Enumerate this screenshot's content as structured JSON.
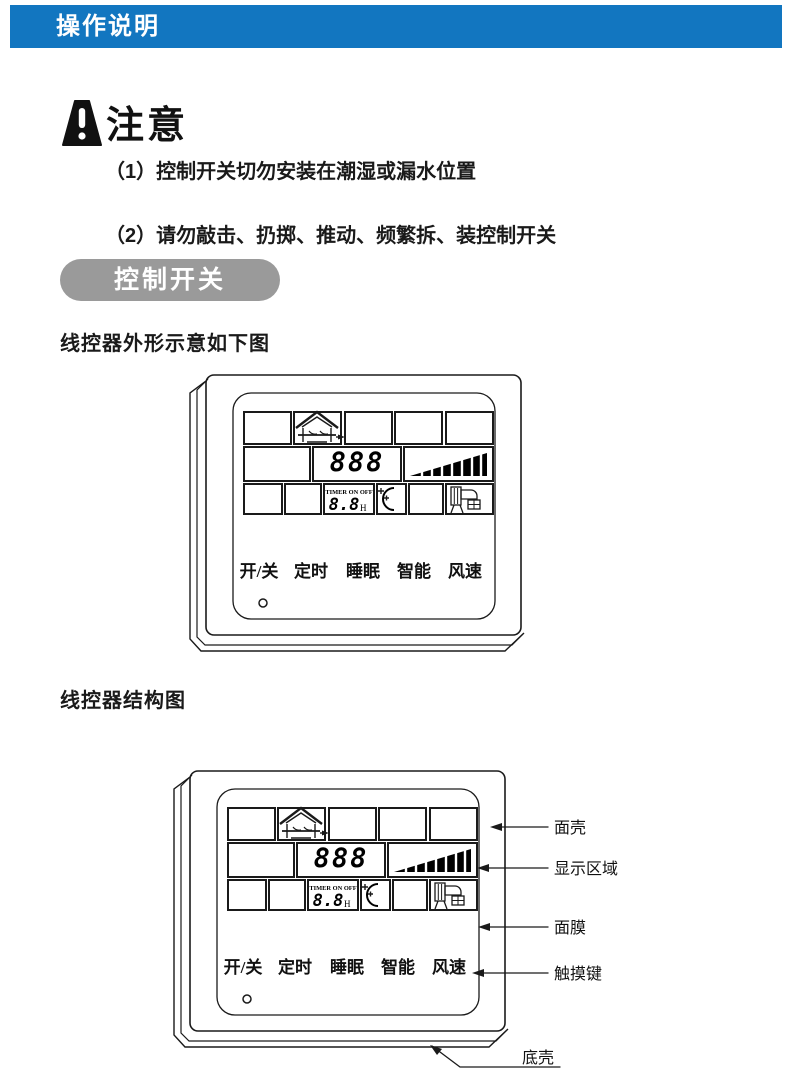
{
  "header": {
    "title": "操作说明",
    "bg_color": "#1276c0",
    "text_color": "#ffffff"
  },
  "notice": {
    "title": "注意",
    "icon": "warning-exclamation-icon",
    "items": [
      "（1）控制开关切勿安装在潮湿或漏水位置",
      "（2）请勿敲击、扔掷、推动、频繁拆、装控制开关"
    ]
  },
  "section": {
    "pill_label": "控制开关",
    "pill_color": "#9a9a9a"
  },
  "figure1": {
    "heading": "线控器外形示意如下图"
  },
  "figure2": {
    "heading": "线控器结构图"
  },
  "controller": {
    "display": {
      "digits": "888",
      "timer_label": "TIMER ON OFF",
      "timer_digits": "8.8",
      "timer_unit": "H",
      "icons": [
        "house-swing-icon",
        "fan-speed-ramp-icon",
        "sleep-moon-icon",
        "ac-unit-icon"
      ]
    },
    "buttons": [
      "开/关",
      "定时",
      "睡眠",
      "智能",
      "风速"
    ],
    "line_color": "#1a1a1a"
  },
  "callouts": [
    "面壳",
    "显示区域",
    "面膜",
    "触摸键",
    "底壳"
  ]
}
